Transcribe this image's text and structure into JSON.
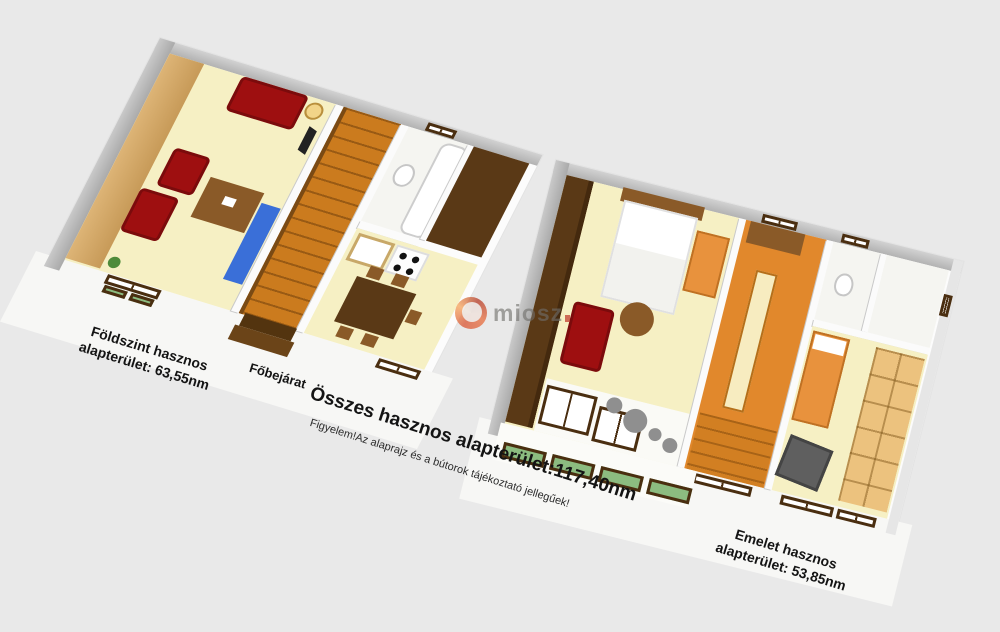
{
  "background_color": "#e9e9e9",
  "watermark": {
    "text": "miosz"
  },
  "labels": {
    "ground_floor_line1": "Földszint hasznos",
    "ground_floor_line2": "alapterület: 63,55nm",
    "entrance": "Főbejárat",
    "total": "Összes hasznos alapterület:117,40nm",
    "warning": "Figyelem!Az alaprajz és a bútorok tájékoztató jellegűek!",
    "upper_floor_line1": "Emelet hasznos",
    "upper_floor_line2": "alapterület: 53,85nm"
  },
  "areas": {
    "ground_floor_nm": "63,55",
    "upper_floor_nm": "53,85",
    "total_nm": "117,40"
  },
  "colors": {
    "background": "#e9e9e9",
    "floor_cream": "#f6f0c4",
    "wall_white": "#fbfbfb",
    "wall_gray": "#b8b8b8",
    "furniture_red": "#9e0f10",
    "wood_tan": "#ddb476",
    "wood_dark": "#5a3916",
    "stair_orange": "#cb7b1e",
    "floor_orange": "#e1882c",
    "accent_orange": "#e8923d",
    "accent_blue": "#3a6fd8",
    "planter_green": "#8cbc80"
  }
}
